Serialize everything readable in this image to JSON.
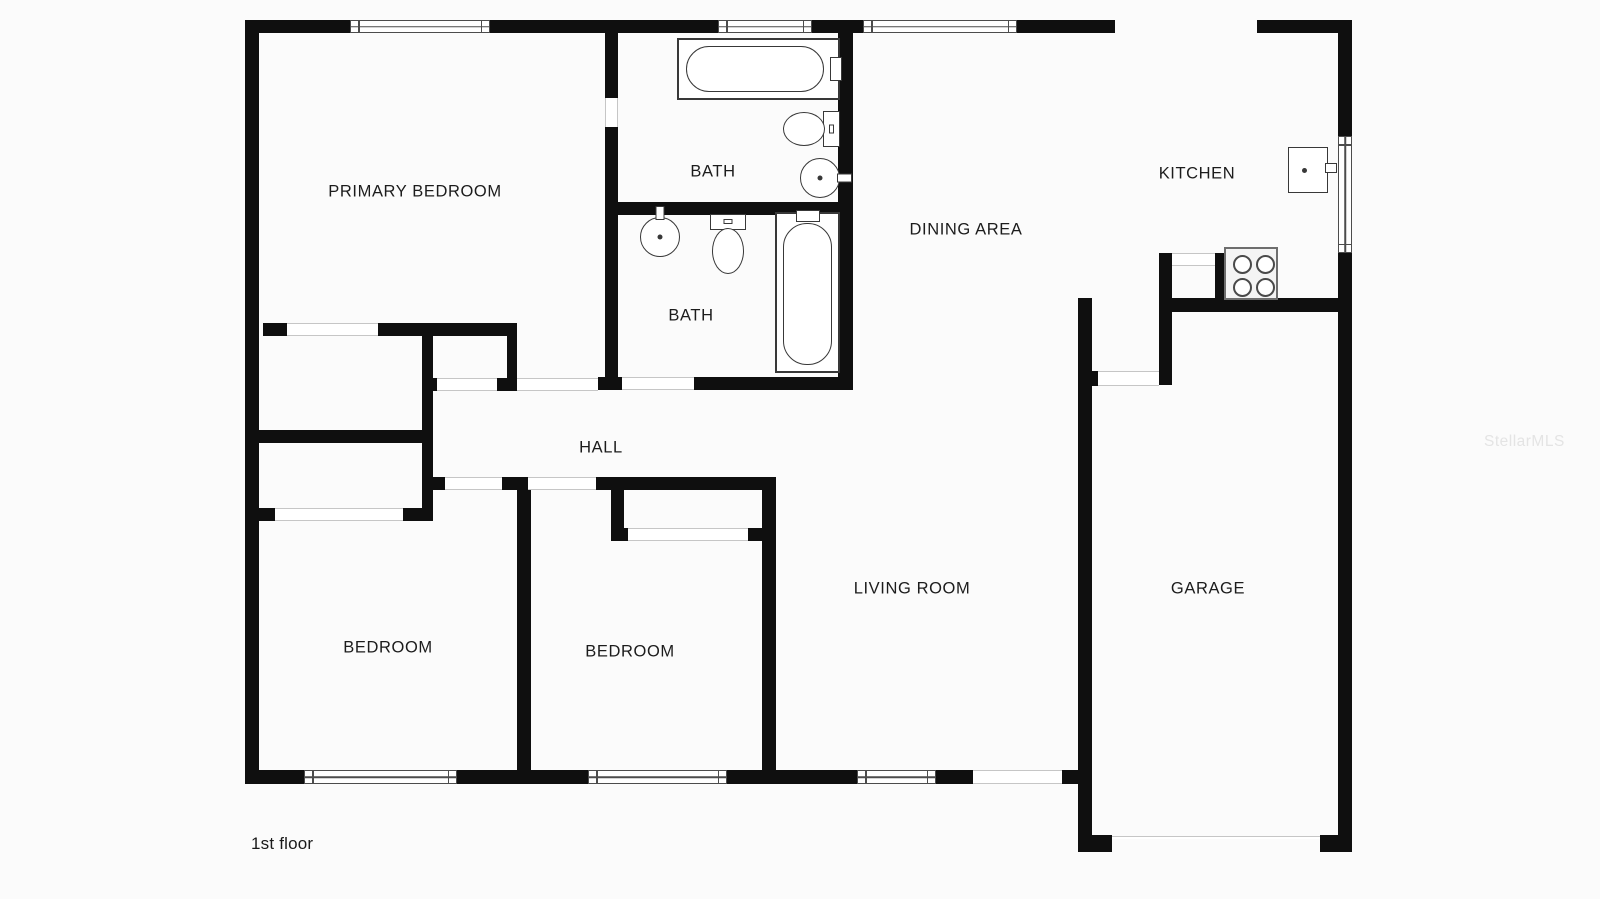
{
  "floor_label": "1st floor",
  "watermark": "StellarMLS",
  "colors": {
    "wall": "#0f0f0f",
    "background": "#fbfbfb",
    "fixture_stroke": "#383838",
    "window_stroke": "#4c4c4c",
    "opening_line": "#c6c6c6",
    "label_text": "#1c1c1c",
    "watermark_text": "#e4e4e4"
  },
  "canvas": {
    "width": 1600,
    "height": 899
  },
  "rooms": [
    {
      "id": "primary-bedroom",
      "label": "PRIMARY BEDROOM",
      "cx": 415,
      "cy": 192
    },
    {
      "id": "bath-1",
      "label": "BATH",
      "cx": 713,
      "cy": 172
    },
    {
      "id": "bath-2",
      "label": "BATH",
      "cx": 691,
      "cy": 316
    },
    {
      "id": "dining-area",
      "label": "DINING AREA",
      "cx": 966,
      "cy": 230
    },
    {
      "id": "kitchen",
      "label": "KITCHEN",
      "cx": 1197,
      "cy": 174
    },
    {
      "id": "hall",
      "label": "HALL",
      "cx": 601,
      "cy": 448
    },
    {
      "id": "bedroom-1",
      "label": "BEDROOM",
      "cx": 388,
      "cy": 648
    },
    {
      "id": "bedroom-2",
      "label": "BEDROOM",
      "cx": 630,
      "cy": 652
    },
    {
      "id": "living-room",
      "label": "LIVING ROOM",
      "cx": 912,
      "cy": 589
    },
    {
      "id": "garage",
      "label": "GARAGE",
      "cx": 1208,
      "cy": 589
    }
  ],
  "walls": [
    [
      245,
      20,
      105,
      13
    ],
    [
      490,
      20,
      228,
      13
    ],
    [
      812,
      20,
      51,
      13
    ],
    [
      1017,
      20,
      98,
      13
    ],
    [
      1257,
      20,
      95,
      13
    ],
    [
      245,
      20,
      14,
      750
    ],
    [
      1338,
      20,
      14,
      116
    ],
    [
      1338,
      253,
      14,
      582
    ],
    [
      1320,
      835,
      32,
      17
    ],
    [
      245,
      770,
      59,
      14
    ],
    [
      457,
      770,
      131,
      14
    ],
    [
      727,
      770,
      130,
      14
    ],
    [
      936,
      770,
      37,
      14
    ],
    [
      1062,
      770,
      16,
      14
    ],
    [
      1078,
      835,
      34,
      17
    ],
    [
      605,
      20,
      13,
      78
    ],
    [
      605,
      127,
      13,
      263
    ],
    [
      598,
      377,
      24,
      13
    ],
    [
      608,
      202,
      245,
      13
    ],
    [
      838,
      33,
      15,
      357
    ],
    [
      694,
      377,
      144,
      13
    ],
    [
      263,
      323,
      24,
      13
    ],
    [
      378,
      323,
      139,
      13
    ],
    [
      422,
      323,
      11,
      198
    ],
    [
      259,
      430,
      173,
      13
    ],
    [
      507,
      323,
      10,
      55
    ],
    [
      497,
      378,
      20,
      13
    ],
    [
      422,
      378,
      15,
      13
    ],
    [
      403,
      508,
      29,
      13
    ],
    [
      259,
      508,
      16,
      13
    ],
    [
      432,
      477,
      13,
      13
    ],
    [
      502,
      477,
      26,
      13
    ],
    [
      517,
      490,
      14,
      280
    ],
    [
      596,
      477,
      176,
      13
    ],
    [
      762,
      477,
      14,
      293
    ],
    [
      611,
      490,
      13,
      38
    ],
    [
      611,
      528,
      17,
      13
    ],
    [
      748,
      528,
      14,
      13
    ],
    [
      1159,
      253,
      13,
      132
    ],
    [
      1215,
      253,
      12,
      45
    ],
    [
      1159,
      298,
      179,
      14
    ],
    [
      1078,
      298,
      14,
      554
    ],
    [
      1092,
      371,
      6,
      15
    ]
  ],
  "windows": [
    {
      "x": 350,
      "y": 20,
      "w": 140,
      "h": 13,
      "orient": "h"
    },
    {
      "x": 718,
      "y": 20,
      "w": 94,
      "h": 13,
      "orient": "h"
    },
    {
      "x": 863,
      "y": 20,
      "w": 154,
      "h": 13,
      "orient": "h"
    },
    {
      "x": 304,
      "y": 770,
      "w": 153,
      "h": 14,
      "orient": "h"
    },
    {
      "x": 588,
      "y": 770,
      "w": 139,
      "h": 14,
      "orient": "h"
    },
    {
      "x": 857,
      "y": 770,
      "w": 79,
      "h": 14,
      "orient": "h"
    },
    {
      "x": 1338,
      "y": 136,
      "w": 14,
      "h": 117,
      "orient": "v"
    }
  ],
  "door_openings": [
    {
      "x": 287,
      "y": 323,
      "w": 91,
      "h": 13,
      "orient": "h"
    },
    {
      "x": 275,
      "y": 508,
      "w": 128,
      "h": 13,
      "orient": "h"
    },
    {
      "x": 437,
      "y": 378,
      "w": 60,
      "h": 13,
      "orient": "h"
    },
    {
      "x": 517,
      "y": 378,
      "w": 81,
      "h": 13,
      "orient": "h"
    },
    {
      "x": 622,
      "y": 377,
      "w": 72,
      "h": 13,
      "orient": "h"
    },
    {
      "x": 445,
      "y": 477,
      "w": 57,
      "h": 13,
      "orient": "h"
    },
    {
      "x": 528,
      "y": 477,
      "w": 68,
      "h": 13,
      "orient": "h"
    },
    {
      "x": 628,
      "y": 528,
      "w": 120,
      "h": 13,
      "orient": "h"
    },
    {
      "x": 605,
      "y": 98,
      "w": 13,
      "h": 29,
      "orient": "v"
    },
    {
      "x": 1172,
      "y": 253,
      "w": 43,
      "h": 13,
      "orient": "h"
    },
    {
      "x": 1098,
      "y": 371,
      "w": 61,
      "h": 15,
      "orient": "h"
    },
    {
      "x": 973,
      "y": 770,
      "w": 89,
      "h": 14,
      "orient": "h"
    }
  ],
  "garage_door": {
    "x": 1112,
    "y": 836,
    "w": 208
  },
  "fixtures": [
    {
      "type": "tub",
      "name": "bathtub",
      "x": 677,
      "y": 38,
      "w": 163,
      "h": 62,
      "faucet": "right"
    },
    {
      "type": "toilet",
      "name": "toilet",
      "x": 783,
      "y": 110,
      "w": 57,
      "h": 38,
      "orient": "right"
    },
    {
      "type": "sink",
      "name": "sink",
      "x": 800,
      "y": 158,
      "w": 40,
      "h": 40,
      "faucet": "right"
    },
    {
      "type": "sink",
      "name": "sink",
      "x": 640,
      "y": 217,
      "w": 40,
      "h": 40,
      "faucet": "top"
    },
    {
      "type": "toilet",
      "name": "toilet",
      "x": 710,
      "y": 214,
      "w": 36,
      "h": 60,
      "orient": "top"
    },
    {
      "type": "tub",
      "name": "bathtub",
      "x": 775,
      "y": 212,
      "w": 65,
      "h": 161,
      "faucet": "top"
    },
    {
      "type": "stove",
      "name": "stove",
      "x": 1224,
      "y": 247,
      "w": 54,
      "h": 53
    },
    {
      "type": "fridge",
      "name": "refrigerator",
      "x": 1288,
      "y": 147,
      "w": 40,
      "h": 46
    }
  ]
}
